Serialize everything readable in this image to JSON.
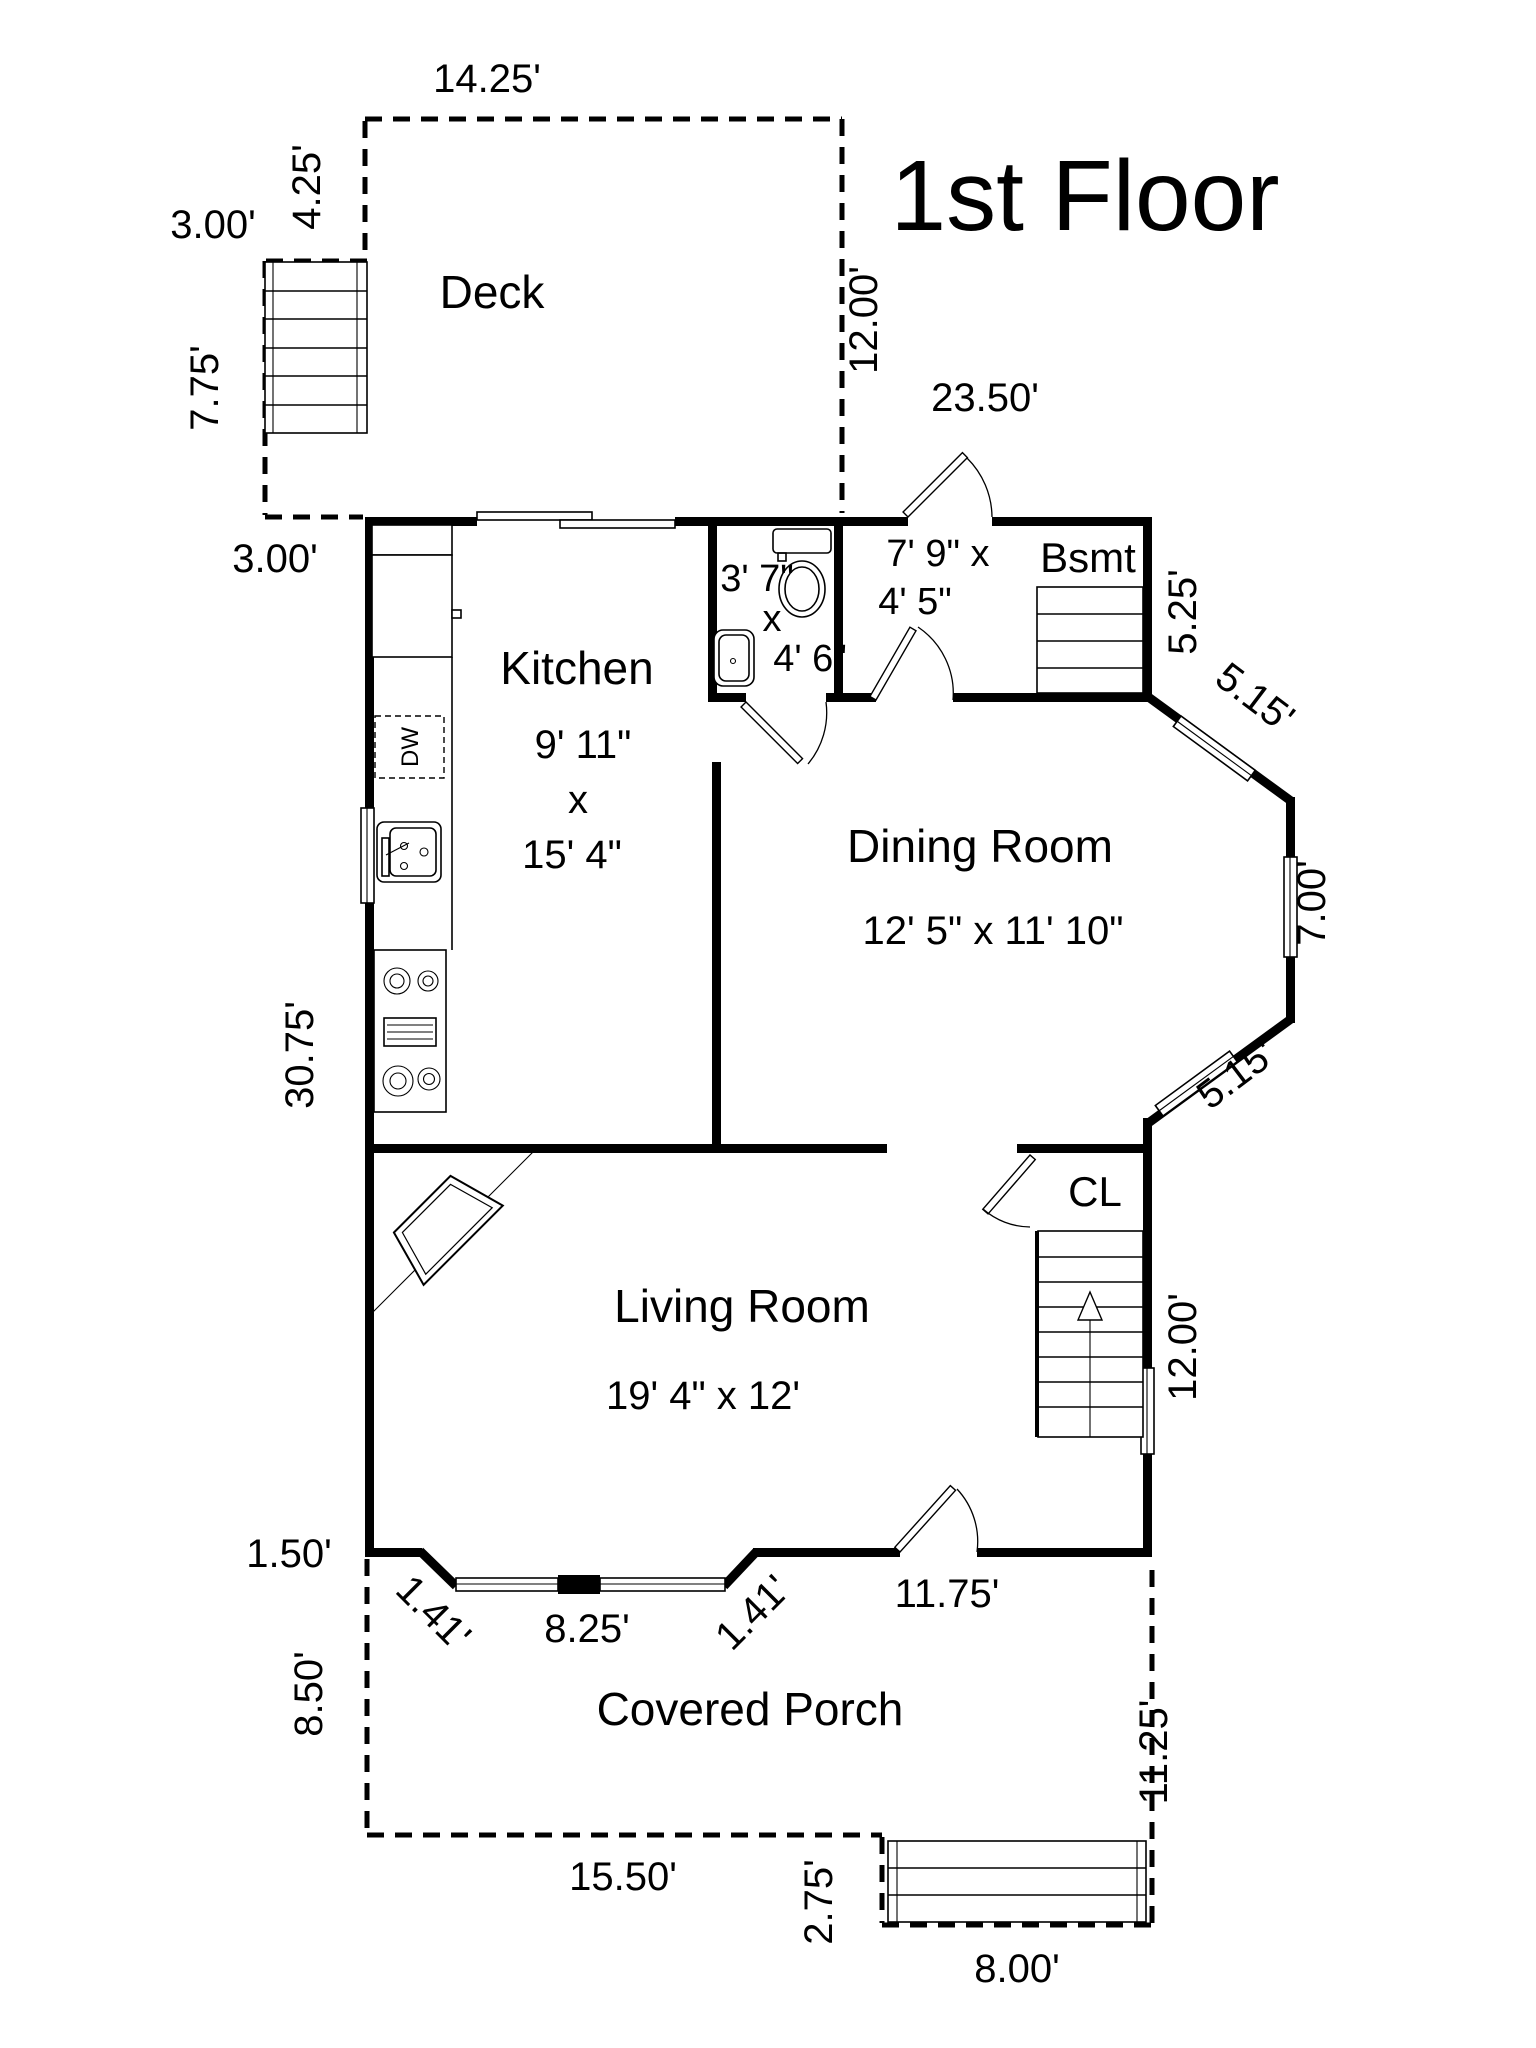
{
  "title": "1st Floor",
  "rooms": {
    "deck": {
      "label": "Deck"
    },
    "kitchen": {
      "label": "Kitchen",
      "dim1": "9' 11\"",
      "dim2": "x",
      "dim3": "15' 4\""
    },
    "dining": {
      "label": "Dining Room",
      "dims": "12' 5\" x 11' 10\""
    },
    "living": {
      "label": "Living Room",
      "dims": "19' 4\" x 12'"
    },
    "porch": {
      "label": "Covered Porch"
    },
    "bath": {
      "dim1": "3' 7\"",
      "dim2": "x",
      "dim3": "4' 6\""
    },
    "hall": {
      "dim1": "7' 9\" x",
      "dim2": "4' 5\""
    },
    "basement": {
      "label": "Bsmt"
    },
    "closet": {
      "label": "CL"
    },
    "appliances": {
      "dishwasher": "DW"
    }
  },
  "dimensions": {
    "deck_top": "14.25'",
    "deck_left": "4.25'",
    "deck_stair_width": "3.00'",
    "deck_stair_height": "7.75'",
    "deck_stair_width_bottom": "3.00'",
    "deck_right": "12.00'",
    "house_top": "23.50'",
    "basement_side": "5.25'",
    "bay_upper": "5.15'",
    "bay_right": "7.00'",
    "bay_lower": "5.15'",
    "left_wall": "30.75'",
    "stair_side": "12.00'",
    "bottom_left": "1.50'",
    "chamfer_left": "1.41'",
    "bay_bottom": "8.25'",
    "chamfer_right": "1.41'",
    "bottom_right": "11.75'",
    "porch_left": "8.50'",
    "porch_right": "11.25'",
    "porch_bottom": "15.50'",
    "stoop_side": "2.75'",
    "stoop_bottom": "8.00'"
  },
  "colors": {
    "wall": "#000000",
    "background": "#ffffff"
  }
}
